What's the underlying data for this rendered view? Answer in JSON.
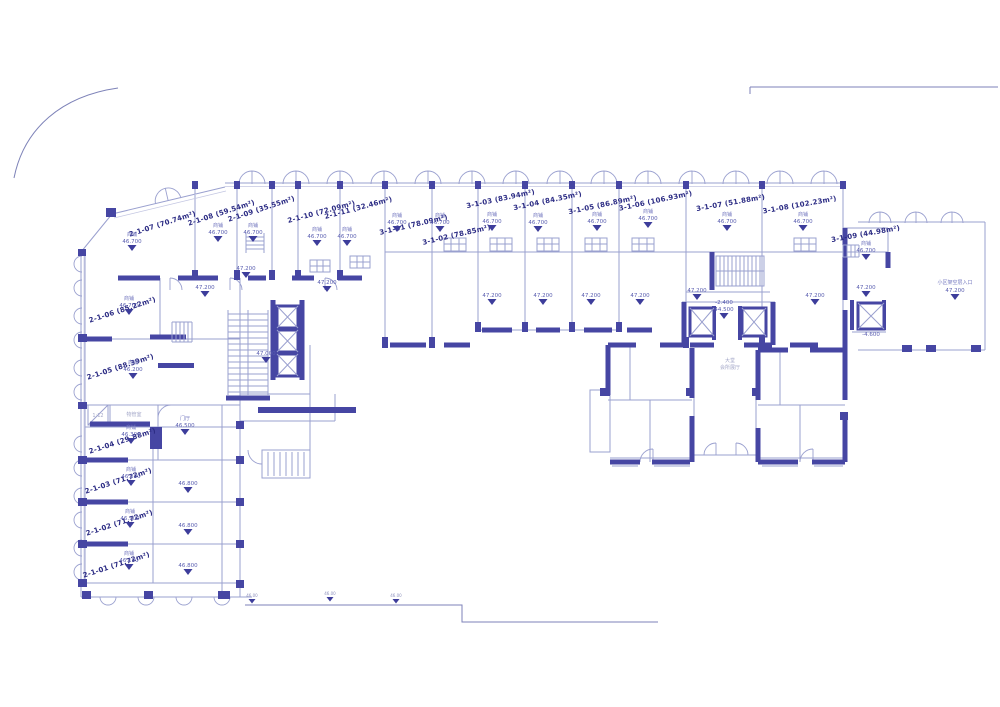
{
  "plan": {
    "texts": {
      "shop": "商铺",
      "hall": "门厅",
      "lobby1": "大堂",
      "lobby2": "会所展厅",
      "pm": "物管室",
      "ramp": "1:12",
      "entrance": "小区架空层入口"
    },
    "levels": {
      "v47200": "47.200",
      "v47000": "47.000",
      "v46500": "46.500",
      "v46800": "46.800",
      "v44500": "44.500",
      "vm2400": "-2.400",
      "vm4600": "-4.600",
      "site": "46.00"
    },
    "units": [
      {
        "label": "2-1-01 (71.72m²)",
        "level": "46.100"
      },
      {
        "label": "2-1-02 (71.72m²)",
        "level": "46.100"
      },
      {
        "label": "2-1-03 (71.72m²)",
        "level": "46.300"
      },
      {
        "label": "2-1-04 (29.88m²)",
        "level": "46.300"
      },
      {
        "label": "2-1-05 (88.39m²)",
        "level": "46.200"
      },
      {
        "label": "2-1-06 (85.22m²)",
        "level": "46.700"
      },
      {
        "label": "2-1-07 (70.74m²)",
        "level": "46.700"
      },
      {
        "label": "2-1-08 (59.54m²)",
        "level": "46.700"
      },
      {
        "label": "2-1-09 (35.55m²)",
        "level": "46.700"
      },
      {
        "label": "2-1-10 (72.09m²)",
        "level": "46.700"
      },
      {
        "label": "2-1-11 (32.46m²)",
        "level": "46.700"
      },
      {
        "label": "3-1-01 (78.09m²)",
        "level": "46.700"
      },
      {
        "label": "3-1-02 (78.85m²)",
        "level": "46.700"
      },
      {
        "label": "3-1-03 (83.94m²)",
        "level": "46.700"
      },
      {
        "label": "3-1-04 (84.35m²)",
        "level": "46.700"
      },
      {
        "label": "3-1-05 (86.89m²)",
        "level": "46.700"
      },
      {
        "label": "3-1-06 (106.93m²)",
        "level": "46.700"
      },
      {
        "label": "3-1-07 (51.88m²)",
        "level": "46.700"
      },
      {
        "label": "3-1-08 (102.23m²)",
        "level": "46.700"
      },
      {
        "label": "3-1-09 (44.98m²)",
        "level": "46.700"
      }
    ]
  }
}
